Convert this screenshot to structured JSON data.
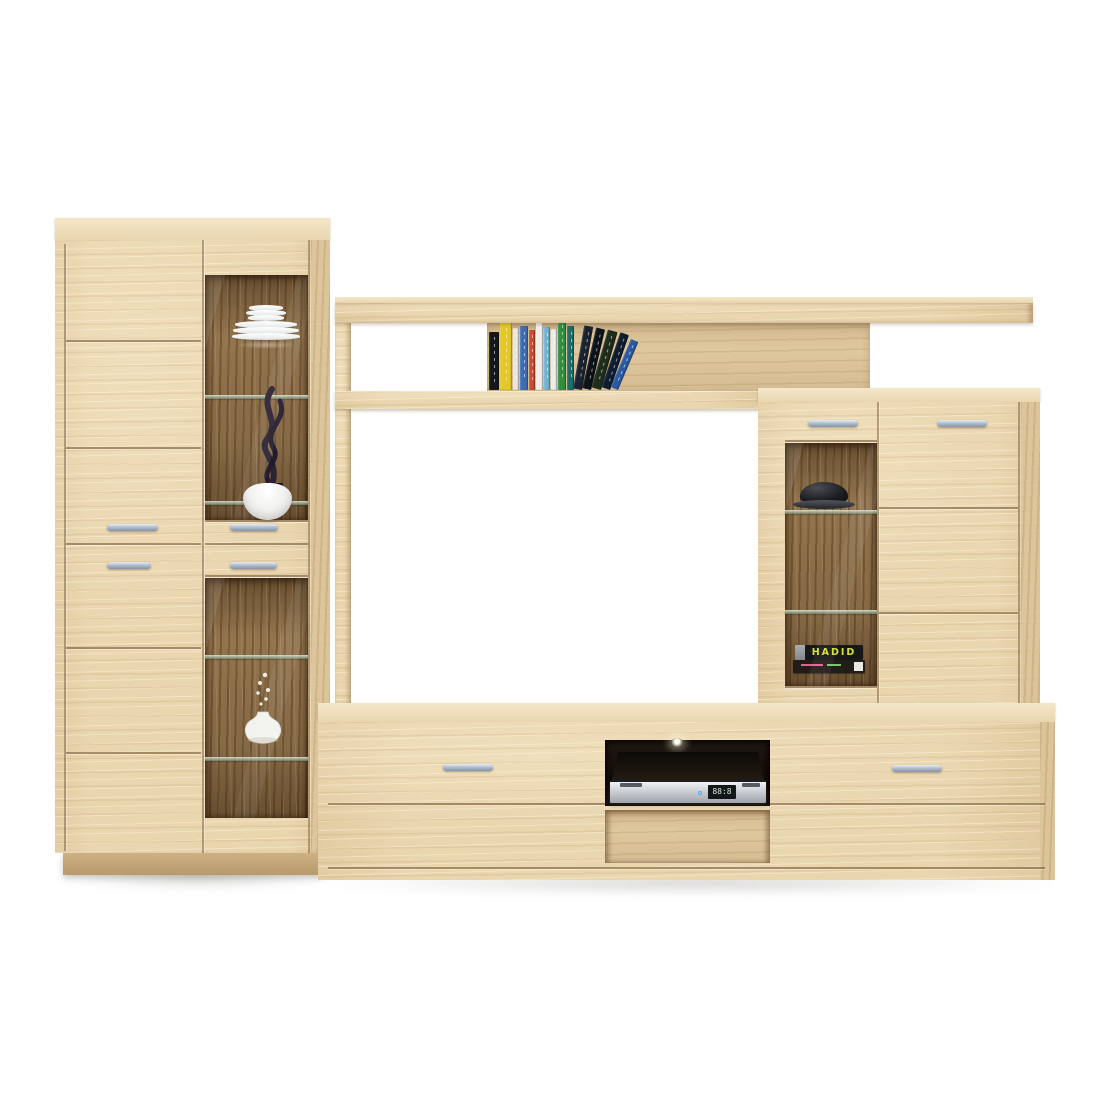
{
  "scene": {
    "type": "furniture product photo",
    "subject": "light oak living-room wall unit with display cabinets, wall shelf and TV stand",
    "background_color": "#ffffff"
  },
  "colors": {
    "wood_front": "#e9d5ae",
    "wood_top": "#f4e7c9",
    "wood_side": "#dcc398",
    "wood_back_panel": "#dfc79e",
    "wood_interior_dark": "#93754e",
    "handle_metal": "#aab6c6",
    "plinth": "#c3a678"
  },
  "left_cabinet": {
    "decor": [
      "stacked-white-plates",
      "black-flame-sculpture",
      "white-bowl",
      "white-vase-with-twigs"
    ],
    "doors": 2,
    "small_drawers": 2,
    "glass_windows": 2
  },
  "wall_shelf": {
    "books": {
      "vertical": [
        {
          "color": "#15161a",
          "w": 10,
          "h": 58
        },
        {
          "color": "#e3c827",
          "w": 12,
          "h": 68
        },
        {
          "color": "#e8e6de",
          "w": 6,
          "h": 62
        },
        {
          "color": "#3e6cb4",
          "w": 8,
          "h": 64
        },
        {
          "color": "#cc4a30",
          "w": 6,
          "h": 60
        },
        {
          "color": "#f0efe9",
          "w": 7,
          "h": 70
        },
        {
          "color": "#6fb3d2",
          "w": 6,
          "h": 63
        },
        {
          "color": "#e9efe6",
          "w": 6,
          "h": 61
        },
        {
          "color": "#2f8f3e",
          "w": 8,
          "h": 71
        },
        {
          "color": "#1d6b6b",
          "w": 7,
          "h": 64
        }
      ],
      "leaning": [
        {
          "color": "#1b2330",
          "x": 2,
          "w": 9,
          "h": 64,
          "angle": 10
        },
        {
          "color": "#0e131a",
          "x": 11,
          "w": 9,
          "h": 62,
          "angle": 13
        },
        {
          "color": "#1f2d1c",
          "x": 20,
          "w": 10,
          "h": 60,
          "angle": 16
        },
        {
          "color": "#101c30",
          "x": 30,
          "w": 9,
          "h": 58,
          "angle": 19
        },
        {
          "color": "#2b5aa0",
          "x": 39,
          "w": 8,
          "h": 52,
          "angle": 23
        }
      ]
    }
  },
  "right_cabinet": {
    "decor": [
      "black-bowl-on-glass-shelf"
    ],
    "display_book": {
      "title": "HADID",
      "title_color": "#d6e030",
      "spine_color": "#17181a"
    },
    "doors": 1,
    "drawers": 1,
    "glass_windows": 1
  },
  "tv_stand": {
    "drawers": 2,
    "player": {
      "kind": "dvd-player",
      "display_text": "88:8"
    },
    "niche_light": true
  }
}
